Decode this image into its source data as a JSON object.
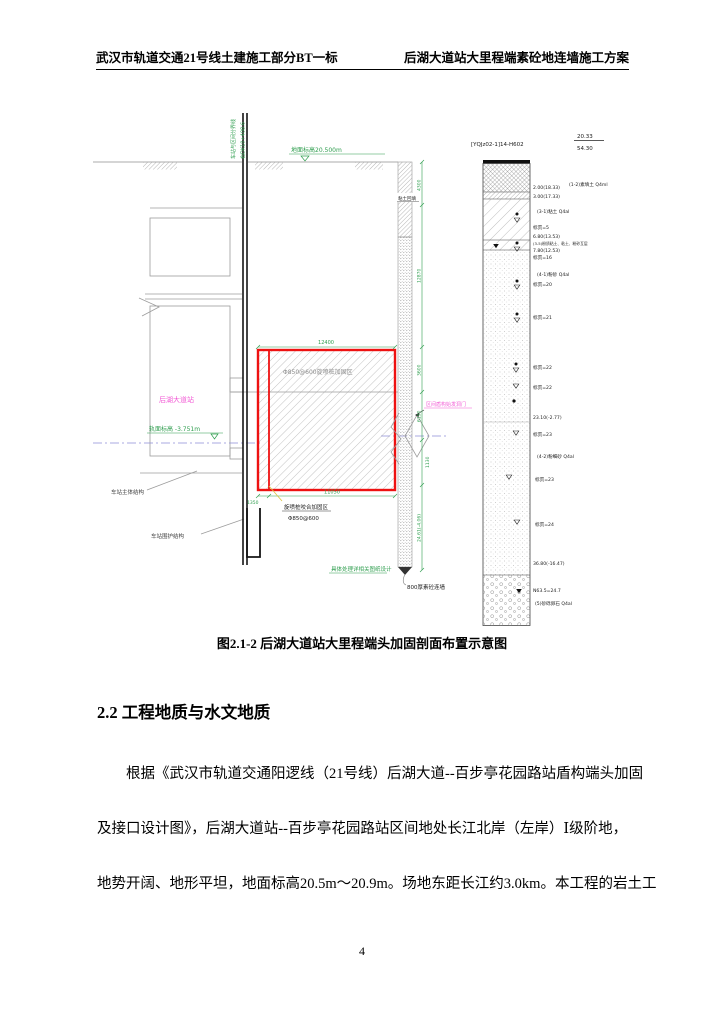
{
  "header": {
    "left": "武汉市轨道交通21号线土建施工部分BT一标",
    "right": "后湖大道站大里程端素砼地连墙施工方案"
  },
  "figure": {
    "caption": "图2.1-2  后湖大道站大里程端头加固剖面布置示意图",
    "labels": {
      "boundary_line": "车站与区间分界线",
      "chainage": "右DK10+408.6",
      "ground_elevation": "地面标高20.500m",
      "station_name": "后湖大道站",
      "rail_elevation": "轨面标高 -3.751m",
      "grout_zone": "Φ850@600旋喷桩加固区",
      "grout_note_line1": "旋喷桩咬合加固区",
      "grout_note_line2": "Φ850@600",
      "station_main_structure": "车站主体结构",
      "station_retaining_structure": "车站围护结构",
      "clay_backfill": "粘土回填",
      "tunnel_portal": "区间盾构始发洞门",
      "treatment_note": "具体处理详相关图纸设计",
      "plain_wall": "800厚素砼连墙"
    },
    "dims": {
      "top": "12400",
      "bottom_left": "1350",
      "bottom_right": "11050",
      "r1": "4300",
      "r2": "12870",
      "r3": "3600",
      "r4": "6190",
      "r5": "1130",
      "r6": "24.61(-4.06)"
    },
    "borehole": {
      "id": "[YQJz02-1]14-H602",
      "top_elevation": "20.33",
      "total_depth": "54.30",
      "notes": [
        "2.00(18.33)",
        "(1-2)素填土 Q4ml",
        "3.00(17.33)",
        "(3-1)粘土 Q4al",
        "标贯=5",
        "6.80(13.53)",
        "(3-5)粉质粘土、粘土、粉砂互层",
        "7.80(12.53)",
        "标贯=16",
        "(4-1)粉砂 Q4al",
        "标贯=20",
        "标贯=21",
        "标贯=22",
        "标贯=22",
        "23.10(-2.77)",
        "标贯=23",
        "(4-2)粉细砂 Q4al",
        "标贯=23",
        "标贯=24",
        "36.80(-16.47)",
        "N63.5=24.7",
        "(5)砂砾卵石 Q4al"
      ]
    }
  },
  "section_heading": "2.2 工程地质与水文地质",
  "paragraph": {
    "line1": "根据《武汉市轨道交通阳逻线（21号线）后湖大道--百步亭花园路站盾构端头加固",
    "line2": "及接口设计图》，后湖大道站--百步亭花园路站区间地处长江北岸（左岸）Ⅰ级阶地，",
    "line3": "地势开阔、地形平坦，地面标高20.5m～20.9m。场地东距长江约3.0km。本工程的岩土工"
  },
  "page_number": "4"
}
